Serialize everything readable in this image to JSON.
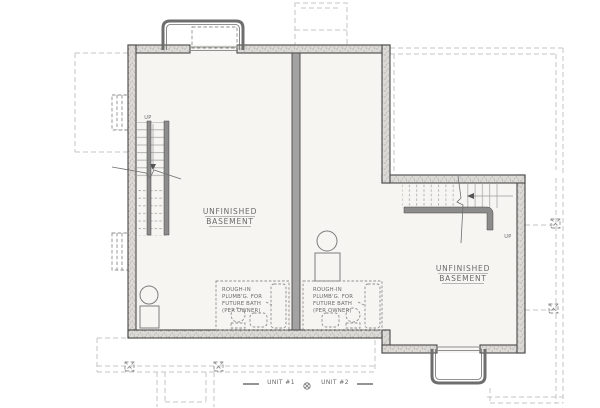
{
  "plan": {
    "rooms": [
      {
        "line1": "UNFINISHED",
        "line2": "BASEMENT"
      },
      {
        "line1": "UNFINISHED",
        "line2": "BASEMENT"
      }
    ],
    "bath_note": {
      "line1": "ROUGH-IN",
      "line2": "PLUMB'G. FOR",
      "line3": "FUTURE BATH",
      "line4": "(PER OWNER)"
    },
    "stair_up_label": "UP",
    "units": [
      {
        "label": "UNIT #1"
      },
      {
        "label": "UNIT #2"
      }
    ]
  },
  "colors": {
    "wall_stroke": "#474747",
    "wall_fill": "#dcdad6",
    "wall_speckle": "#a19d96",
    "party_fill": "#a3a3a3",
    "floor_fill": "#f6f5f2",
    "dash_light": "#c6c6c6",
    "dash_med": "#8f8f8f",
    "text_color": "#696969",
    "well_stroke": "#6e6e6e",
    "rail_fill": "#8c8c8c",
    "tread": "#b2b2b2"
  }
}
